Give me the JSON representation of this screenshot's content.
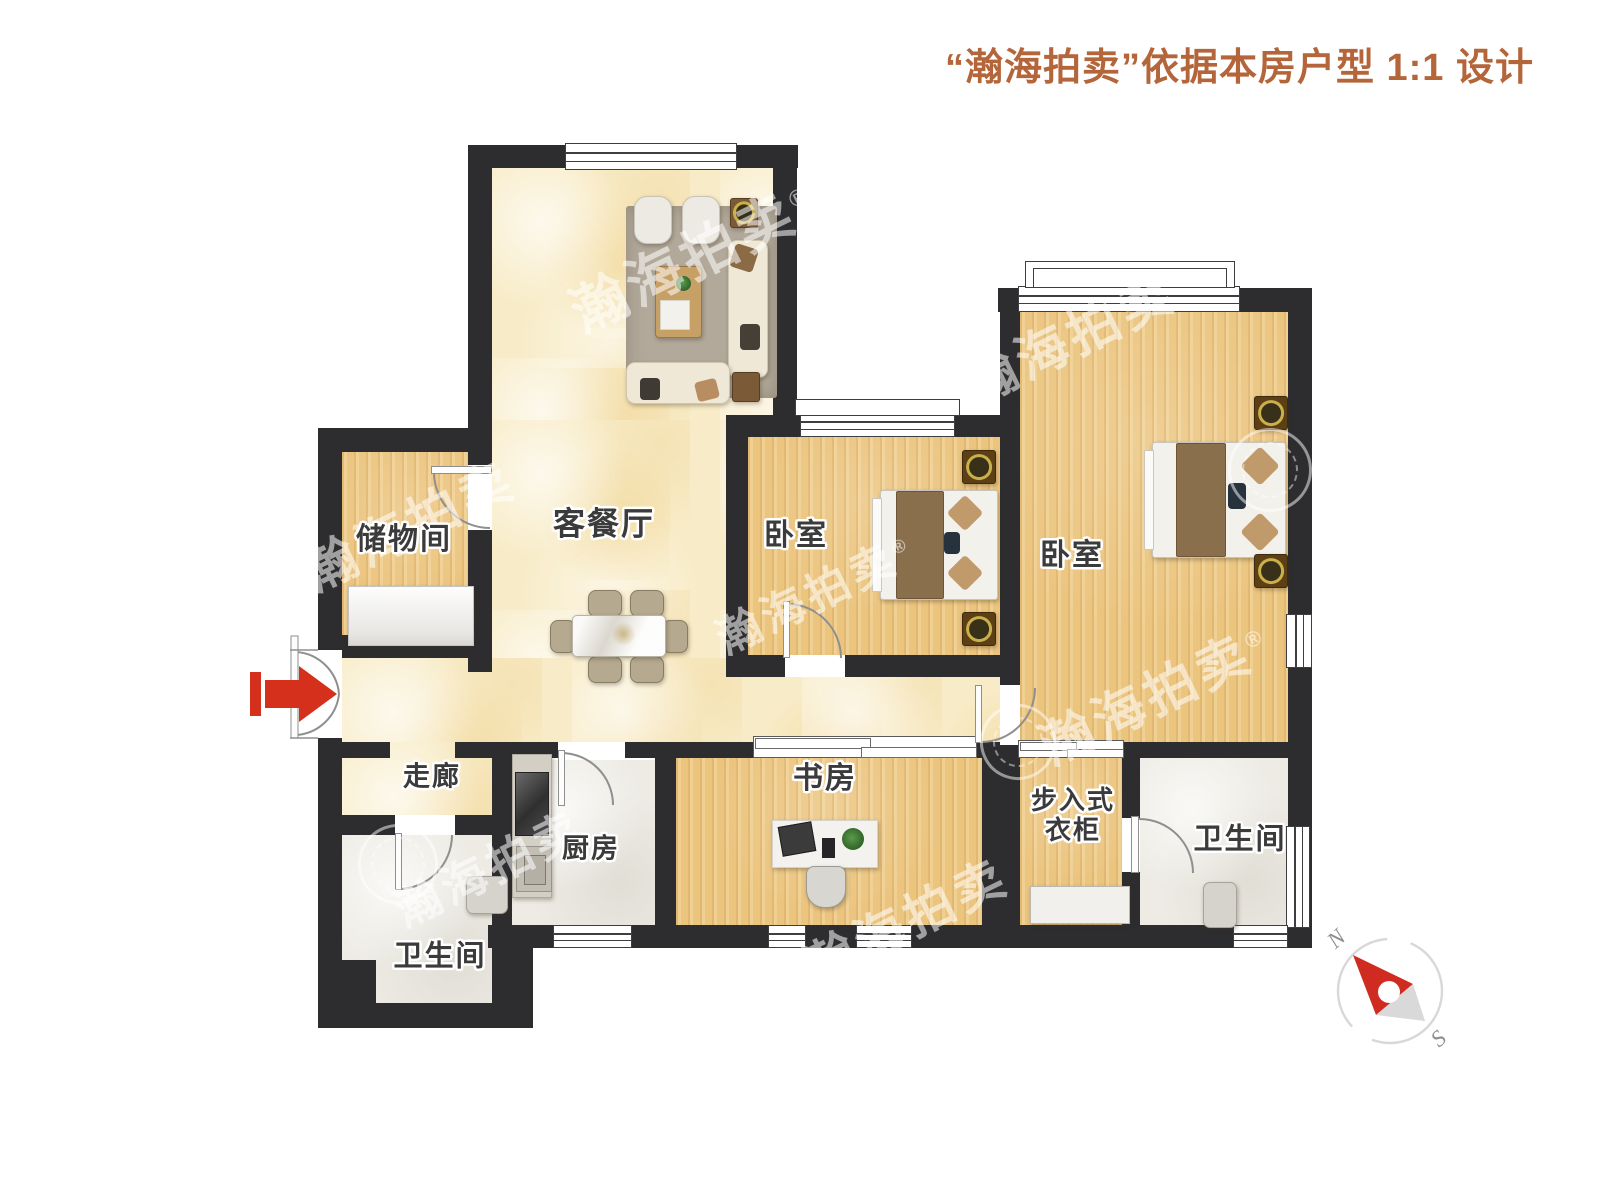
{
  "title": "“瀚海拍卖”依据本房户型 1:1 设计",
  "rooms": {
    "living": "客餐厅",
    "storage": "储物间",
    "bedroom_left": "卧室",
    "bedroom_right": "卧室",
    "corridor": "走廊",
    "kitchen": "厨房",
    "bathroom_left": "卫生间",
    "bathroom_right": "卫生间",
    "study": "书房",
    "closet": "步入式\n衣柜"
  },
  "watermark": {
    "text": "瀚海拍卖",
    "registered": "®"
  },
  "compass": {
    "north": "N",
    "south": "S"
  },
  "colors": {
    "wall": "#2d2d2f",
    "floor_wood": "#ebc47e",
    "floor_marble": "#f8ecc8",
    "floor_tile": "#edebe4",
    "title_text": "#b4663a",
    "entry_arrow": "#d5301b"
  }
}
